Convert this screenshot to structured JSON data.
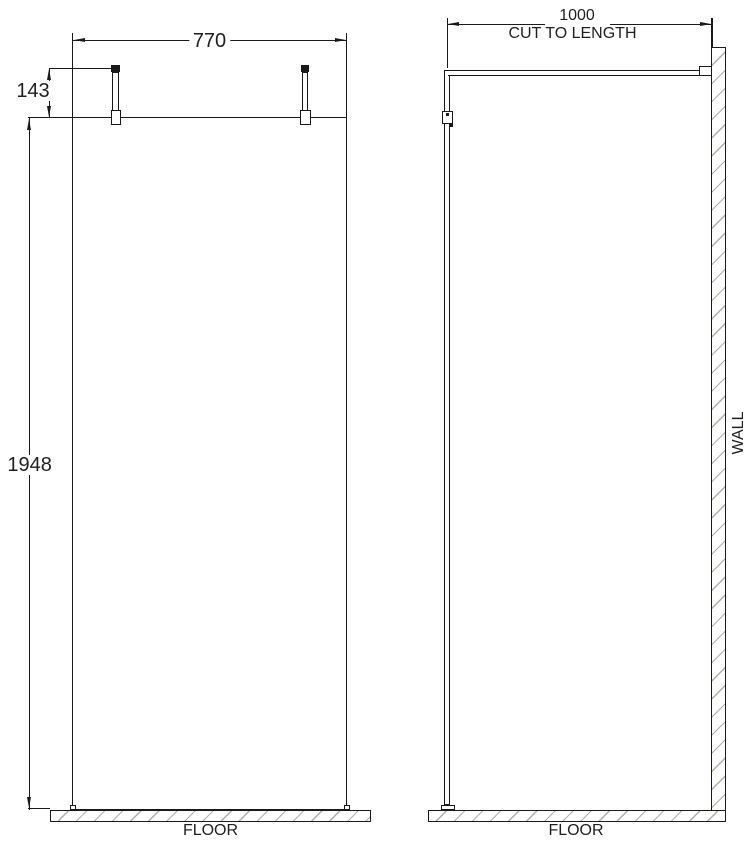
{
  "front_view": {
    "width_dimension": "770",
    "post_height_dimension": "143",
    "panel_height_dimension": "1948",
    "floor_label": "FLOOR"
  },
  "side_view": {
    "arm_length_dimension": "1000",
    "arm_note": "CUT TO LENGTH",
    "wall_label": "WALL",
    "floor_label": "FLOOR"
  },
  "colors": {
    "line": "#1a1a1a",
    "hatch": "#b3aca2",
    "background": "#ffffff",
    "text": "#1f1f1f"
  }
}
